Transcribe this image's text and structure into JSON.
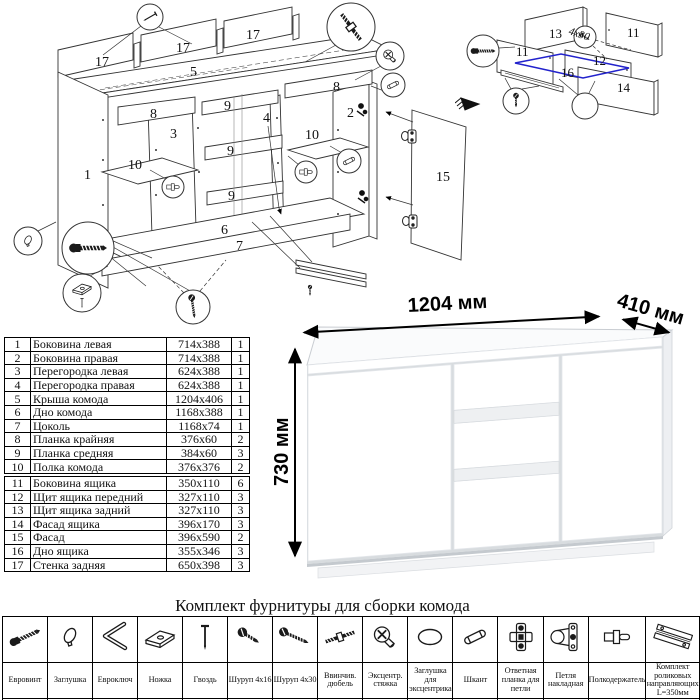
{
  "hardware_title": "Комплект фурнитуры для сборки комода",
  "dimensions": {
    "width": "1204 мм",
    "depth": "410 мм",
    "height": "730 мм"
  },
  "parts_table": {
    "section1": [
      {
        "num": "1",
        "name": "Боковина левая",
        "size": "714x388",
        "qty": "1"
      },
      {
        "num": "2",
        "name": "Боковина правая",
        "size": "714x388",
        "qty": "1"
      },
      {
        "num": "3",
        "name": "Перегородка левая",
        "size": "624x388",
        "qty": "1"
      },
      {
        "num": "4",
        "name": "Перегородка правая",
        "size": "624x388",
        "qty": "1"
      },
      {
        "num": "5",
        "name": "Крыша комода",
        "size": "1204x406",
        "qty": "1"
      },
      {
        "num": "6",
        "name": "Дно комода",
        "size": "1168x388",
        "qty": "1"
      },
      {
        "num": "7",
        "name": "Цоколь",
        "size": "1168x74",
        "qty": "1"
      },
      {
        "num": "8",
        "name": "Планка крайняя",
        "size": "376x60",
        "qty": "2"
      },
      {
        "num": "9",
        "name": "Планка средняя",
        "size": "384x60",
        "qty": "3"
      },
      {
        "num": "10",
        "name": "Полка комода",
        "size": "376x376",
        "qty": "2"
      }
    ],
    "section2": [
      {
        "num": "11",
        "name": "Боковина ящика",
        "size": "350x110",
        "qty": "6"
      },
      {
        "num": "12",
        "name": "Щит ящика передний",
        "size": "327x110",
        "qty": "3"
      },
      {
        "num": "13",
        "name": "Щит ящика задний",
        "size": "327x110",
        "qty": "3"
      },
      {
        "num": "14",
        "name": "Фасад ящика",
        "size": "396x170",
        "qty": "3"
      },
      {
        "num": "15",
        "name": "Фасад",
        "size": "396x590",
        "qty": "2"
      },
      {
        "num": "16",
        "name": "Дно ящика",
        "size": "355x346",
        "qty": "3"
      },
      {
        "num": "17",
        "name": "Стенка задняя",
        "size": "650x398",
        "qty": "3"
      }
    ]
  },
  "hardware": {
    "title": "Комплект фурнитуры для сборки комода",
    "items": [
      {
        "name": "Евровинт",
        "qty": "22",
        "icon": "eurobolt"
      },
      {
        "name": "Заглушка",
        "qty": "6",
        "icon": "cap"
      },
      {
        "name": "Евроключ",
        "qty": "1",
        "icon": "hexkey"
      },
      {
        "name": "Ножка",
        "qty": "5",
        "icon": "foot"
      },
      {
        "name": "Гвоздь",
        "qty": "100",
        "icon": "nail"
      },
      {
        "name": "Шуруп 4х16",
        "qty": "28",
        "icon": "screw-short"
      },
      {
        "name": "Шуруп 4х30",
        "qty": "6",
        "icon": "screw-long"
      },
      {
        "name": "Ввинчив. дюбель",
        "qty": "8",
        "icon": "dowel-screw"
      },
      {
        "name": "Эксцентр. стяжка",
        "qty": "8",
        "icon": "cam"
      },
      {
        "name": "Заглушка для эксцентрика",
        "qty": "8",
        "icon": "cam-cap"
      },
      {
        "name": "Шкант",
        "qty": "20",
        "icon": "dowel"
      },
      {
        "name": "Ответная планка для петли",
        "qty": "4",
        "icon": "hinge-plate"
      },
      {
        "name": "Петля накладная",
        "qty": "4",
        "icon": "hinge"
      },
      {
        "name": "Полкодержатель",
        "qty": "8",
        "icon": "shelf-holder"
      },
      {
        "name": "Комплект роликовых направляющих L=350мм",
        "qty": "3",
        "icon": "rails"
      }
    ]
  },
  "diagrams": {
    "main": {
      "labels": [
        {
          "t": "17",
          "x": 95,
          "y": 66
        },
        {
          "t": "17",
          "x": 176,
          "y": 52
        },
        {
          "t": "17",
          "x": 246,
          "y": 39
        },
        {
          "t": "5",
          "x": 190,
          "y": 76
        },
        {
          "t": "8",
          "x": 150,
          "y": 118
        },
        {
          "t": "8",
          "x": 333,
          "y": 91
        },
        {
          "t": "3",
          "x": 170,
          "y": 138
        },
        {
          "t": "4",
          "x": 263,
          "y": 122
        },
        {
          "t": "9",
          "x": 224,
          "y": 110
        },
        {
          "t": "9",
          "x": 227,
          "y": 155
        },
        {
          "t": "9",
          "x": 228,
          "y": 200
        },
        {
          "t": "2",
          "x": 347,
          "y": 117
        },
        {
          "t": "10",
          "x": 128,
          "y": 169
        },
        {
          "t": "10",
          "x": 305,
          "y": 139
        },
        {
          "t": "1",
          "x": 84,
          "y": 179
        },
        {
          "t": "6",
          "x": 221,
          "y": 234
        },
        {
          "t": "7",
          "x": 236,
          "y": 250
        },
        {
          "t": "15",
          "x": 436,
          "y": 181
        }
      ]
    },
    "drawer": {
      "labels": [
        {
          "t": "13",
          "x": 94,
          "y": 38
        },
        {
          "t": "11",
          "x": 172,
          "y": 37
        },
        {
          "t": "11",
          "x": 61,
          "y": 56
        },
        {
          "t": "12",
          "x": 138,
          "y": 65
        },
        {
          "t": "16",
          "x": 106,
          "y": 77
        },
        {
          "t": "14",
          "x": 162,
          "y": 92
        }
      ],
      "note": "4х30"
    }
  }
}
